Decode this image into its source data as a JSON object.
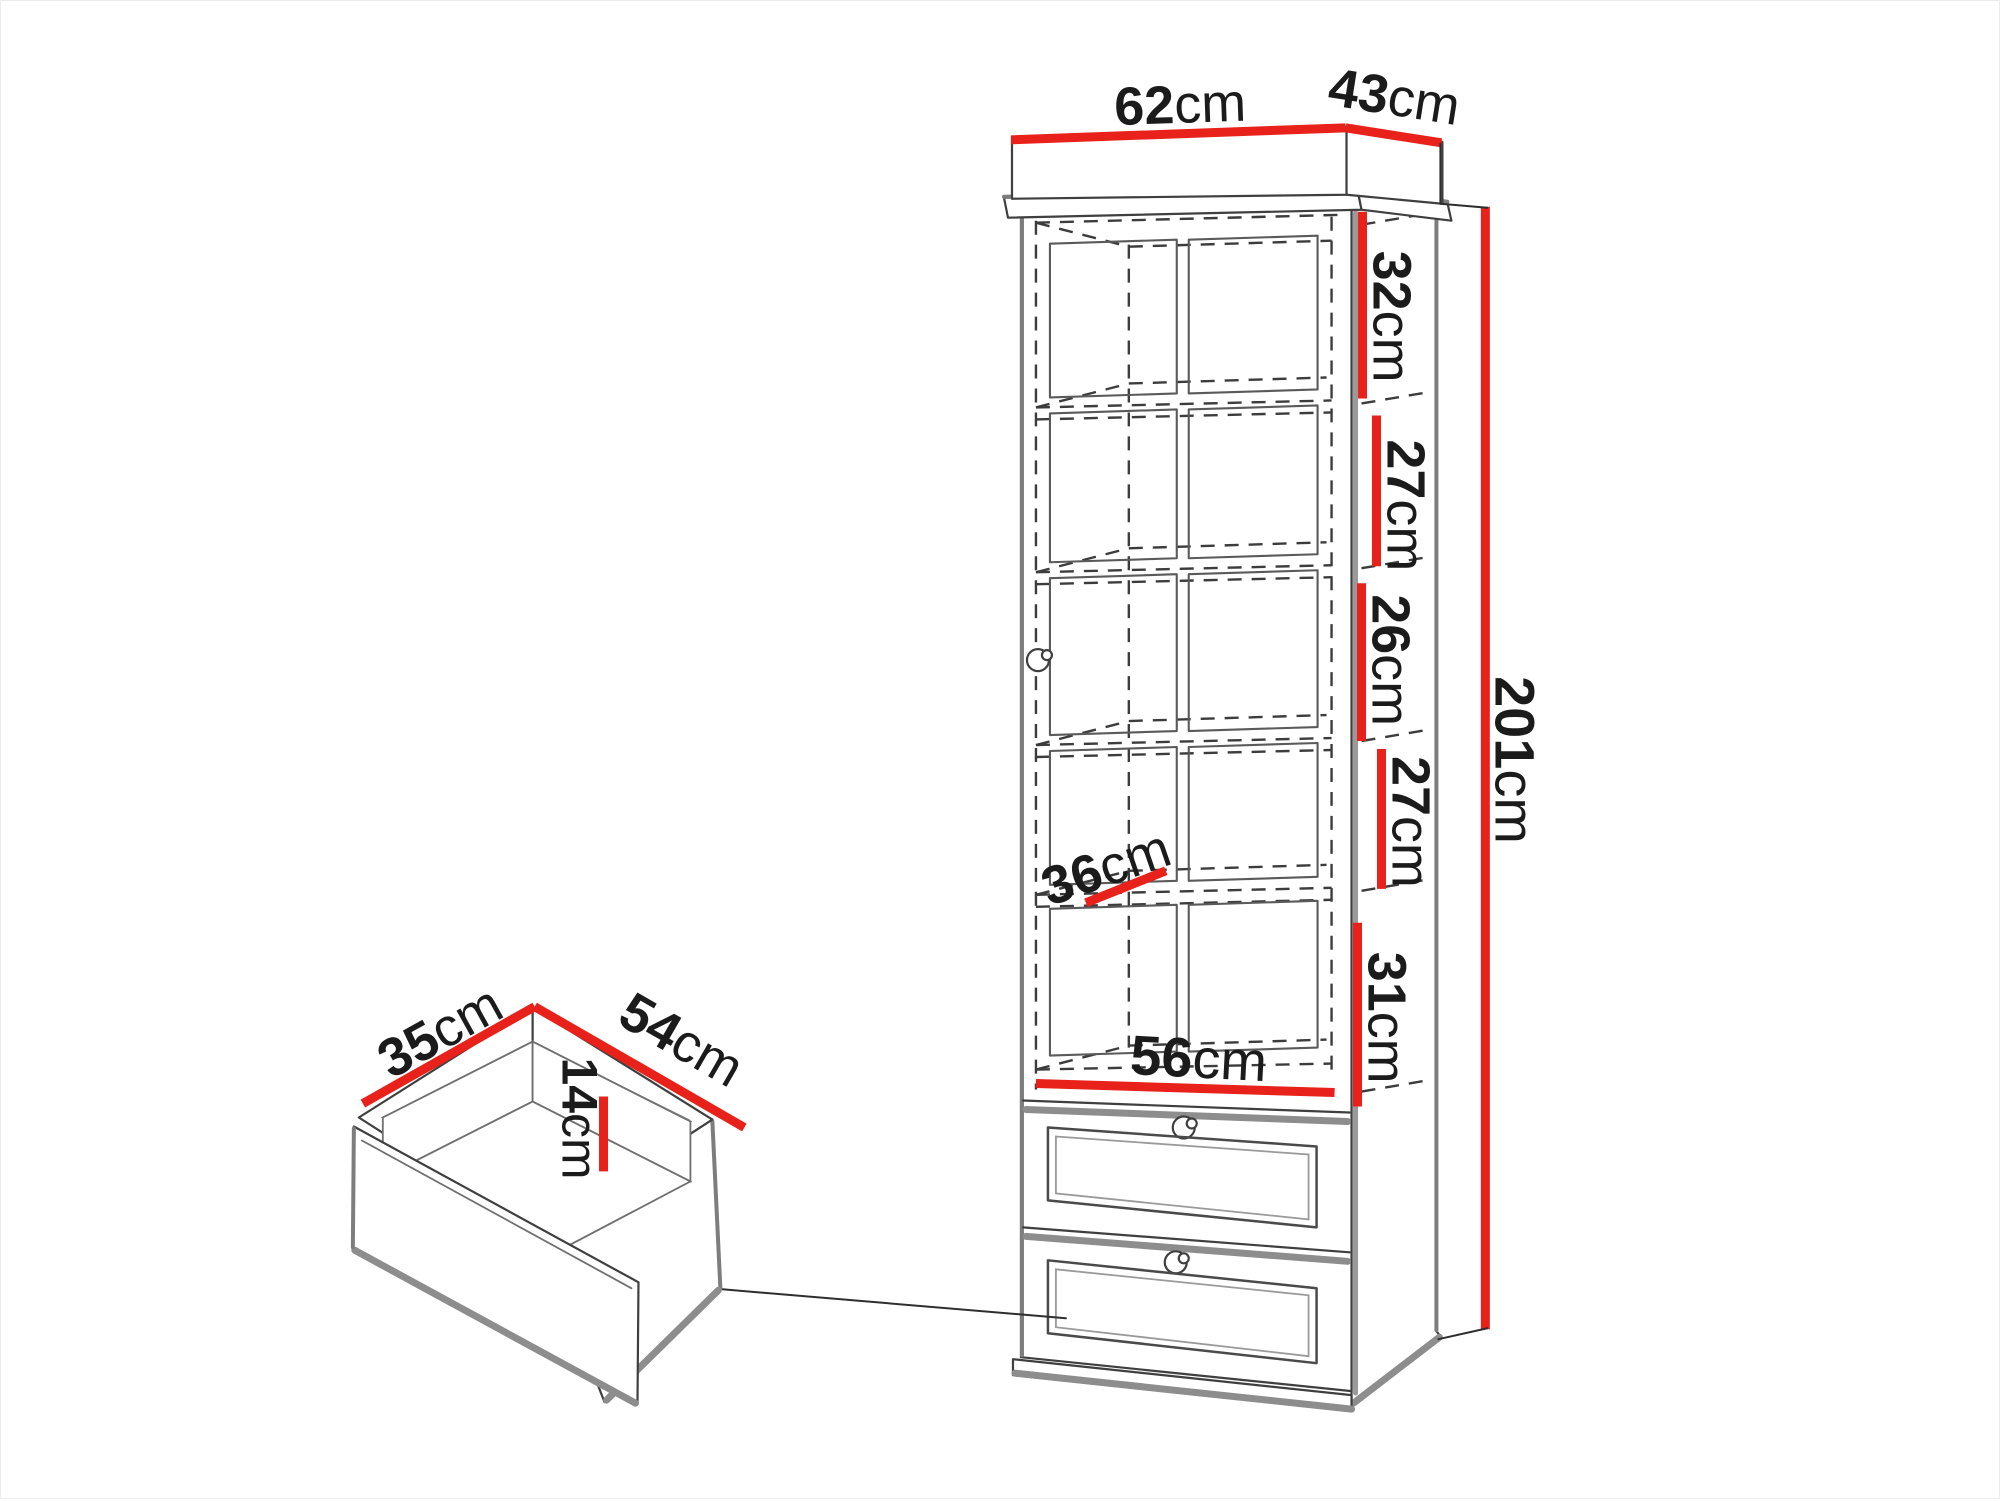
{
  "diagram": {
    "accent_color": "#e8211b",
    "cabinet": {
      "width": {
        "value": "62",
        "unit": "cm"
      },
      "depth": {
        "value": "43",
        "unit": "cm"
      },
      "height": {
        "value": "201",
        "unit": "cm"
      },
      "compartments": [
        {
          "value": "32",
          "unit": "cm"
        },
        {
          "value": "27",
          "unit": "cm"
        },
        {
          "value": "26",
          "unit": "cm"
        },
        {
          "value": "27",
          "unit": "cm"
        },
        {
          "value": "31",
          "unit": "cm"
        }
      ],
      "interior_width": {
        "value": "56",
        "unit": "cm"
      },
      "shelf_depth": {
        "value": "36",
        "unit": "cm"
      }
    },
    "drawer": {
      "depth": {
        "value": "35",
        "unit": "cm"
      },
      "width": {
        "value": "54",
        "unit": "cm"
      },
      "inner_height": {
        "value": "14",
        "unit": "cm"
      }
    }
  }
}
